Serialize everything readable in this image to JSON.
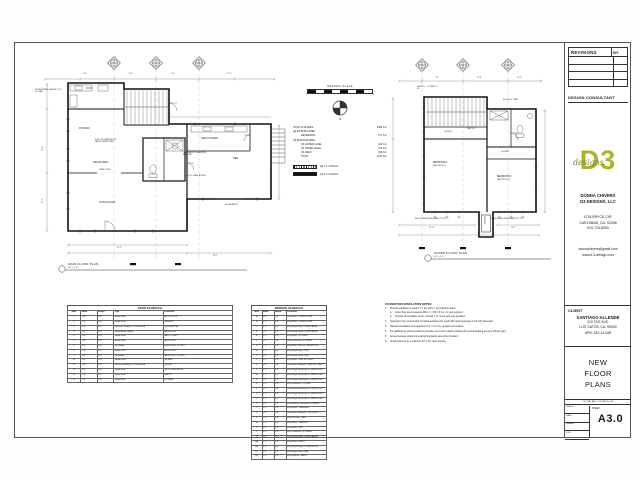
{
  "titleblock": {
    "revisions_label": "REVISIONS",
    "by_label": "BY",
    "design_consultant_label": "DESIGN CONSULTANT",
    "logo": {
      "text": "D3",
      "script": "designs",
      "color": "#aab32e",
      "script_color": "#76861f"
    },
    "firm_name": "DONNA CHIVERS",
    "firm_name2": "D3 DESIGNS, LLC",
    "firm_address1": "4716 BRYCE CIR.",
    "firm_address2": "CARLSBAD, CA. 92008",
    "firm_phone": "510-716-8300",
    "firm_email": "donnachivers@gmail.com",
    "firm_website": "www.d-3-design.com",
    "client_label": "CLIENT",
    "client_name": "SANTIAGO ALLENDE",
    "client_address1": "310 TAIT AVE.",
    "client_address2": "LOS GATOS, CA. 95030",
    "client_apn": "APN: 510-14-068",
    "sheet_title": "NEW FLOOR PLANS",
    "footer_project": "310 TAIT AVE, LOS GATOS, CA",
    "scale_label": "SCALE",
    "date_label": "DATE",
    "drawn_label": "DRAWN",
    "job_label": "JOB",
    "sheet_label": "SHEET",
    "sheet_number": "A3.0"
  },
  "legend": {
    "graphic_scale_label": "GRAPHIC SCALE",
    "scale_ticks": [
      "4",
      "2",
      "0",
      "4",
      "8"
    ],
    "north_label": "N",
    "areas": [
      {
        "label": "TOTAL SITE AREA",
        "value": "2999 S.F.",
        "indent": 0
      },
      {
        "label": "(E) EXISTING AREA",
        "value": "",
        "indent": 0
      },
      {
        "label": "RESIDENCE",
        "value": "717 S.F.",
        "indent": 1
      },
      {
        "label": "(N) BUILDING AREA",
        "value": "",
        "indent": 0
      },
      {
        "label": "(N) LOWER LEVEL",
        "value": "419 S.F.",
        "indent": 1
      },
      {
        "label": "(N) UPPER LEVEL",
        "value": "370 S.F.",
        "indent": 1
      },
      {
        "label": "(N) DECK",
        "value": "199 S.F.",
        "indent": 1
      },
      {
        "label": "TOTAL",
        "value": "1101 S.F.",
        "indent": 1
      }
    ],
    "walls": [
      {
        "label": "(E) 2 X 4 WALLS",
        "style": "hatched"
      },
      {
        "label": "(N) 2 X 6 WALLS",
        "style": "solid"
      }
    ]
  },
  "main_plan": {
    "title": "MAIN FLOOR PLAN",
    "scale": "1/4\" = 1'-0\"",
    "labels": {
      "kitchen": "KITCHEN",
      "dining": "DINING AREA",
      "living": "LIVING ROOM",
      "new_kitchen": "NEW KITCHEN",
      "den": "DEN",
      "pantry_note": "PULL OUT DRAWERS FOR PANTRY UNDER STAIR",
      "safety_note": "TEMP. SAFETY GLASS WDW. MIN. OPEN.",
      "crawl_note": "15\" X 24\" CRAWL ACCESS",
      "gas_note": "(E) GAS METER",
      "railing_note": "(N) WDW RAILING HEIGHT @ 42\" O.C. MAX",
      "cased_open": "CASED OPEN"
    },
    "dims": {
      "top1": "9'-2\"",
      "top2": "8'-0\"",
      "top3": "6'-5\"",
      "top4": "17'-6\"",
      "bottom1": "21'-5\"",
      "bottom2": "16'-7\"",
      "left1": "16'-0\"",
      "left2": "13'-2\""
    }
  },
  "upper_plan": {
    "title": "UPPER FLOOR PLAN",
    "scale": "1/4\" = 1'-0\"",
    "labels": {
      "bedroom1": "BEDROOM 1",
      "bedroom1b": "VAULTED CLG",
      "bedroom2": "BEDROOM 2",
      "bedroom2b": "VAULTED CLG",
      "closet1": "CLOSET",
      "closet2": "CLOSET",
      "flat_clg": "FLAT CLG",
      "chimney": "CHIMNEY",
      "wdw_note1": "(N) DBL GLAZED WDW EGRESS TYP OF 3",
      "wdw_note2": "(N) DBL GLAZED WDW EGRESS TYP OF 3",
      "temp_note": "(N) 5040 SL. TEMP.",
      "ro_note": "WDW R.O. + 7'-0\" ABV T.O. S.F."
    },
    "dims": {
      "top1": "7'-6\"",
      "top2": "13'-6\"",
      "top3": "10'-0\"",
      "bottom1": "16'-11\"",
      "bottom2": "13'-5\""
    }
  },
  "door_schedule": {
    "title": "DOOR SCHEDULE",
    "columns": [
      "Mark",
      "Width",
      "Height",
      "Type",
      "Comments"
    ],
    "rows": [
      [
        "1",
        "3'-0\"",
        "6'-8\"",
        "Single-Flush",
        "ENTRY DOOR"
      ],
      [
        "2",
        "2'-6\"",
        "6'-8\"",
        "Single-Flush",
        "LAUNDRY"
      ],
      [
        "3",
        "6'-0\"",
        "6'-8\"",
        "Dbl Glass Sliding w 2 Panel Wood",
        "(N) DINING RM"
      ],
      [
        "4",
        "2'-6\"",
        "6'-8\"",
        "Single-Acrylic Sliding",
        "BATHROOM"
      ],
      [
        "5",
        "2'-4\"",
        "6'-8\"",
        "Single-Flush",
        "HALL CLOSET"
      ],
      [
        "6",
        "2'-6\"",
        "6'-8\"",
        "Single-Flush",
        "BEDROOM 1"
      ],
      [
        "7",
        "4'-0\"",
        "6'-8\"",
        "Dbl Sliding",
        "BEDROOM 1 CLOSET"
      ],
      [
        "8",
        "2'-6\"",
        "6'-8\"",
        "Single-Flush",
        "BEDROOM 2"
      ],
      [
        "9",
        "4'-0\"",
        "6'-8\"",
        "Dbl Sliding",
        "BEDROOM 2 CLOSET"
      ],
      [
        "10",
        "2'-6\"",
        "6'-8\"",
        "Single-Flush",
        "(N) BATH"
      ],
      [
        "11",
        "6'-0\"",
        "6'-8\"",
        "Dbl Glass Sliding w 2 Panel Wood",
        "(N) DEN"
      ],
      [
        "12",
        "3'-0\"",
        "6'-8\"",
        "Single-Flush",
        "(N) KITCHEN ENTRY"
      ],
      [
        "13",
        "2'-8\"",
        "6'-8\"",
        "Single-Flush",
        "PANTRY"
      ],
      [
        "14",
        "2'-6\"",
        "6'-8\"",
        "Single-Flush",
        "STORAGE"
      ]
    ]
  },
  "window_schedule": {
    "title": "WINDOW SCHEDULE",
    "columns": [
      "Mark",
      "Width",
      "Height",
      "Comments"
    ],
    "rows": [
      [
        "A",
        "4'-0\"",
        "3'-6\"",
        "Vinyl Slider - LIVING ROOM"
      ],
      [
        "B",
        "4'-0\"",
        "3'-6\"",
        "Vinyl Slider - LIVING ROOM"
      ],
      [
        "C",
        "3'-0\"",
        "4'-0\"",
        "Vinyl Single Hung - DINING AREA"
      ],
      [
        "D",
        "3'-0\"",
        "4'-0\"",
        "Vinyl Single Hung - DINING AREA"
      ],
      [
        "E",
        "3'-0\"",
        "3'-0\"",
        "Vinyl Slider - KITCHEN"
      ],
      [
        "F",
        "2'-0\"",
        "3'-0\"",
        "Vinyl Casement - KITCHEN"
      ],
      [
        "G",
        "2'-0\"",
        "2'-0\"",
        "Vinyl Slider Obscure - BATHROOM"
      ],
      [
        "H",
        "3'-0\"",
        "4'-0\"",
        "Vinyl Single Hung - DEN"
      ],
      [
        "I",
        "3'-0\"",
        "4'-0\"",
        "Vinyl Single Hung - DEN"
      ],
      [
        "J",
        "3'-0\"",
        "3'-0\"",
        "Vinyl Slider - NEW KITCHEN"
      ],
      [
        "K",
        "5'-0\"",
        "4'-0\"",
        "Vinyl Slider Tempered - NEW KITCHEN"
      ],
      [
        "L",
        "3'-0\"",
        "4'-0\"",
        "Vinyl Single Hung Egress - BEDROOM 1"
      ],
      [
        "M",
        "3'-0\"",
        "4'-0\"",
        "Vinyl Single Hung Egress - BEDROOM 1"
      ],
      [
        "N",
        "3'-0\"",
        "4'-0\"",
        "Vinyl Single Hung Egress - BEDROOM 1"
      ],
      [
        "O",
        "2'-0\"",
        "3'-0\"",
        "Vinyl Casement - CLOSET"
      ],
      [
        "P",
        "3'-0\"",
        "4'-0\"",
        "Vinyl Single Hung Egress - BEDROOM 2"
      ],
      [
        "Q",
        "3'-0\"",
        "4'-0\"",
        "Vinyl Single Hung Egress - BEDROOM 2"
      ],
      [
        "R",
        "3'-0\"",
        "4'-0\"",
        "Vinyl Single Hung Egress - BEDROOM 2"
      ],
      [
        "S",
        "2'-0\"",
        "2'-0\"",
        "Vinyl Obscure Tempered - (N) BATH"
      ],
      [
        "T",
        "2'-0\"",
        "2'-0\"",
        "Vinyl Fixed - STAIRWELL"
      ],
      [
        "U",
        "5'-0\"",
        "4'-0\"",
        "Vinyl Slider Tempered - (N) 5040 SL"
      ],
      [
        "V",
        "3'-0\"",
        "1'-6\"",
        "Vinyl Transom - HALL"
      ],
      [
        "W",
        "2'-6\"",
        "3'-0\"",
        "Vinyl Slider - LAUNDRY"
      ],
      [
        "X",
        "4'-0\"",
        "3'-0\"",
        "Vinyl Slider - DEN"
      ],
      [
        "Y",
        "2'-0\"",
        "3'-0\"",
        "Vinyl Casement - KITCHEN"
      ],
      [
        "Z",
        "3'-0\"",
        "4'-0\"",
        "Vinyl Single Hung - DINING AREA"
      ],
      [
        "AA",
        "2'-0\"",
        "2'-0\"",
        "Vinyl Fixed - ENTRY"
      ],
      [
        "BB",
        "3'-0\"",
        "4'-0\"",
        "Vinyl Single Hung - LIVING ROOM"
      ],
      [
        "CC",
        "2'-6\"",
        "4'-0\"",
        "Vinyl Single Hung - HALL"
      ],
      [
        "DD",
        "2'-0\"",
        "2'-0\"",
        "Vinyl Obscure - BATH"
      ]
    ]
  },
  "notes": {
    "title": "FOUNDATION VENTILATION NOTES:",
    "items": [
      {
        "num": "1.",
        "text": "Provide ventilation to equal 1 s.f. per 150 s.f. of underfloor space.",
        "subs": [
          {
            "num": "a.",
            "text": "Under floor area measures 990 s.f. / 150 = 6.6 s.f. of vent required."
          },
          {
            "num": "b.",
            "text": "Provide 14 foundation vents - At least 7 s.f. of net vent area provided."
          }
        ]
      },
      {
        "num": "2.",
        "text": "Openings to be covered with corrosion-resistant wire mesh with mesh openings of 1/4 inch dimension."
      },
      {
        "num": "3.",
        "text": "Maintain foundation vent clearance of 3\" x 14\" min. at each vent location."
      },
      {
        "num": "4.",
        "text": "For additions to existing residence provide new vents to match existing with vented blocking at every 3rd bay (typ)."
      },
      {
        "num": "5.",
        "text": "Access between crawl and existing foundation area to be provided."
      },
      {
        "num": "6.",
        "text": "Crawl access to be a minimum 18\" x 24\" clear opening."
      }
    ]
  }
}
